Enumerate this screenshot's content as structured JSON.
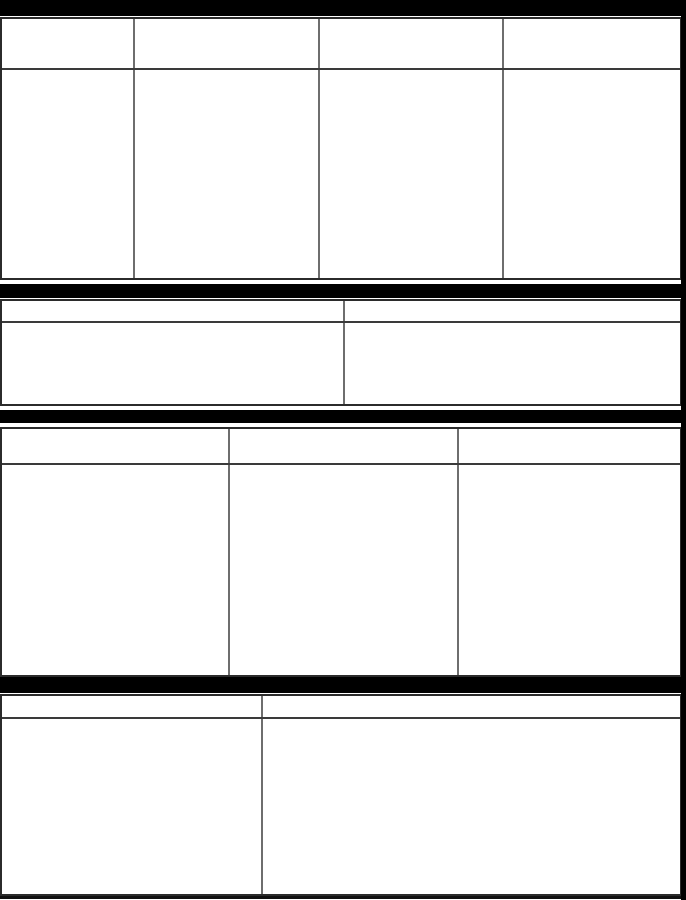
{
  "page": {
    "width_px": 686,
    "height_px": 900,
    "background": "#ffffff",
    "description": "Blank scanned form page: empty tables separated by solid black section bars; no visible text"
  },
  "colors": {
    "section_bar": "#000000",
    "page_right_edge": "#000000",
    "page_bottom_rule": "#111111",
    "table_outer_border": "#2b2b2b",
    "table_inner_divider": "#6e6e6e",
    "header_rule": "#3a3a3a",
    "cell_background": "#ffffff"
  },
  "sections": [
    {
      "name": "top-section-bar",
      "type": "bar",
      "label": ""
    },
    {
      "name": "table-1",
      "type": "table",
      "columns": 4
    },
    {
      "name": "section-bar-2",
      "type": "bar",
      "label": ""
    },
    {
      "name": "table-2",
      "type": "table",
      "columns": 2
    },
    {
      "name": "section-bar-3",
      "type": "bar",
      "label": ""
    },
    {
      "name": "table-3",
      "type": "table",
      "columns": 3
    },
    {
      "name": "section-bar-4",
      "type": "bar",
      "label": ""
    },
    {
      "name": "table-4",
      "type": "table",
      "columns": 2
    }
  ],
  "tables": {
    "t1": {
      "header": [
        "",
        "",
        "",
        ""
      ],
      "body": [
        "",
        "",
        "",
        ""
      ]
    },
    "t2": {
      "header": [
        "",
        ""
      ],
      "body": [
        "",
        ""
      ]
    },
    "t3": {
      "header": [
        "",
        "",
        ""
      ],
      "body": [
        "",
        "",
        ""
      ]
    },
    "t4": {
      "header": [
        "",
        ""
      ],
      "body": [
        "",
        ""
      ]
    }
  }
}
